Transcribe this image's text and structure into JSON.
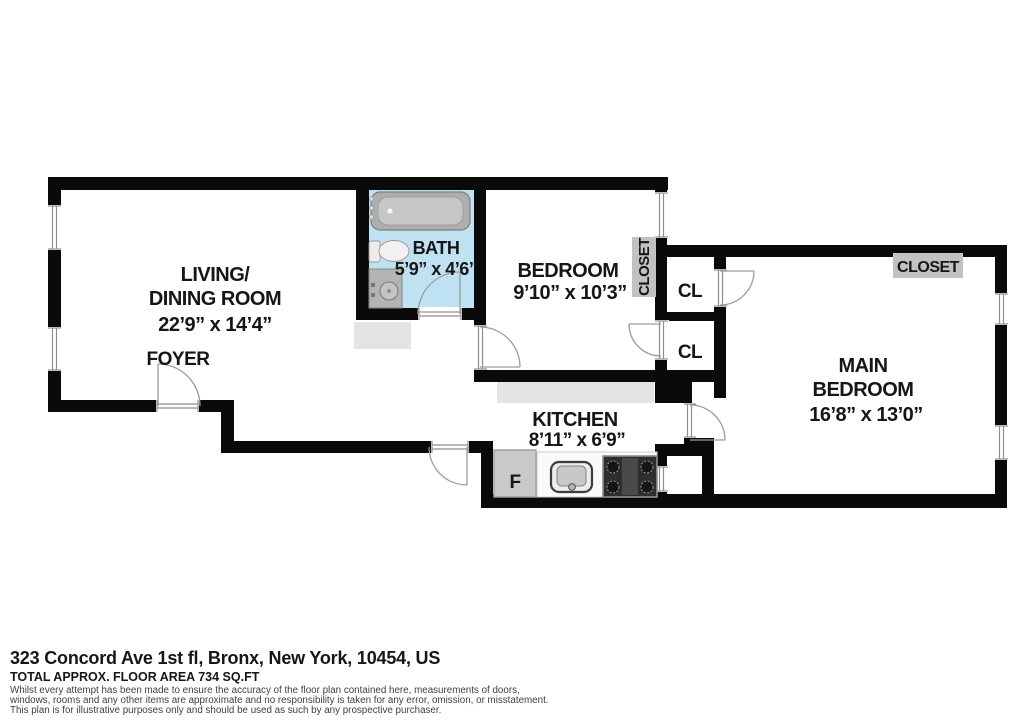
{
  "plan": {
    "rooms": {
      "living_dining": {
        "label_line1": "LIVING/",
        "label_line2": "DINING ROOM",
        "dims": "22’9” x 14’4”"
      },
      "foyer": {
        "label": "FOYER"
      },
      "bath": {
        "label": "BATH",
        "dims": "5’9” x 4’6”"
      },
      "bedroom": {
        "label": "BEDROOM",
        "dims": "9’10” x 10’3”"
      },
      "main_bedroom": {
        "label_line1": "MAIN",
        "label_line2": "BEDROOM",
        "dims": "16’8” x 13’0”"
      },
      "kitchen": {
        "label": "KITCHEN",
        "dims": "8’11” x 6’9”"
      },
      "closet_bedroom": {
        "label": "CLOSET"
      },
      "closet_main_bedroom": {
        "label": "CLOSET"
      },
      "closet_top": {
        "label": "CL"
      },
      "closet_bottom": {
        "label": "CL"
      }
    },
    "fixtures": {
      "fridge_label": "F"
    },
    "colors": {
      "wall": "#0a0a0a",
      "bath_floor": "#bfe2f3",
      "label_bg": "#c2c2c2",
      "door_line": "#9c9c9c",
      "fixture_gray": "#c9c9c9"
    }
  },
  "footer": {
    "address": "323 Concord Ave 1st fl, Bronx, New York, 10454, US",
    "area": "TOTAL APPROX. FLOOR AREA 734 SQ.FT",
    "disclaimer_line1": "Whilst every attempt has been made to ensure the accuracy of the floor plan contained here, measurements of doors,",
    "disclaimer_line2": "windows, rooms and any other items are approximate and no responsibility is taken for any error, omission, or misstatement.",
    "disclaimer_line3": "This plan is for illustrative purposes only and should be used as such by any prospective purchaser."
  }
}
